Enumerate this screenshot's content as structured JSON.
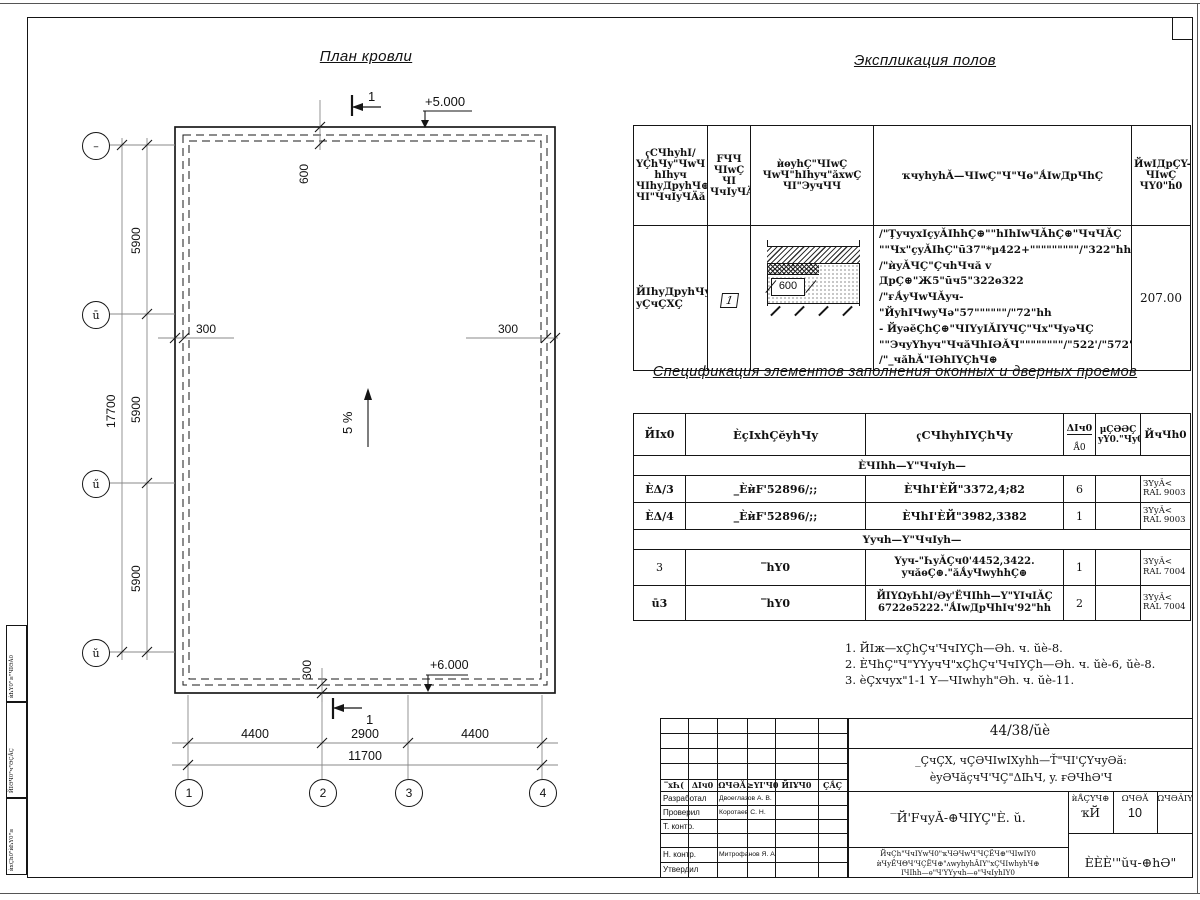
{
  "plan": {
    "title": "План кровли",
    "section_mark": "1",
    "elev_top": "+5.000",
    "elev_bottom": "+6.000",
    "slope": "5 %",
    "d600": "600",
    "d300": "300",
    "d5900": "5900",
    "d17700": "17700",
    "d4400": "4400",
    "d2900": "2900",
    "d11700": "11700",
    "axes_letters": [
      "–",
      "ū",
      "ű",
      "ŭ"
    ],
    "axes_numbers": [
      "1",
      "2",
      "3",
      "4"
    ]
  },
  "explication": {
    "title": "Экспликация полов",
    "h_room": "ҁСЧһyһI/\nYÇhЧy\"ЧwЧ\nһIһyч\nЧIһyДpyһЧ⊕\nЧI\"ЧчIyЧÄă",
    "h_num": "FЧЧ\nЧIwÇ\nЧI\nЧчIyЧÄă",
    "h_sketch": "ѝѳyһÇ\"ЧIwÇ\nЧwЧ\"hIһyч\"ăхwÇ\nЧI\"ЭyчЧЧ",
    "h_desc": "ҡчyһyһǍ—ЧIwÇ\"Ч\"Чѳ\"ǺIwДpЧһÇ",
    "h_area": "ЙwIДpÇY-\nЧIwÇ\nЧY0\"һ0",
    "r_name": "ЙIһyДpyһЧy\nyÇчÇXÇ",
    "r_num": "1",
    "sketch_dim": "600",
    "r_desc": "/\"ŢyчyхIçyǍIhhÇ⊕\"\"hIhIwЧǍhÇ⊕\"ЧчЧǍÇ\n\"\"Чх\"çyǍIhÇ\"ū37\"*μ422+\"\"\"\"\"\"\"\"\"/\"322\"hh\n/\"ѝyǍЧÇ\"ÇчhЧчă v ДpÇ⊕\"Ж5\"ūч5\"322ѳ322\n/\"ғǺyЧwЧǍyч-\"ЙyһIЧwyЧə\"57\"\"\"\"\"\"/\"72\"hh\n- ЙyəĕÇhÇ⊕\"ЧIYyIǍIYЧÇ\"Чх\"ЧyəЧÇ\n\"\"ЭчyYһyч\"ЧчăЧһIƏǍЧ\"\"\"\"\"\"\"\"/\"522'/\"572\"hh\n/\"_чăhǍ\"IƏhIYÇhЧ⊕",
    "r_area": "207.00"
  },
  "specification": {
    "title": "Спецификация элементов заполнения оконных и дверных проемов",
    "h_pos": "ЙIх0",
    "h_mark": "ÈçIxhÇĕyһЧy",
    "h_name": "ҁСЧһyһIYÇhЧy",
    "h_qty_top": "ΔIч0",
    "h_qty_bot": "Ǻ0",
    "h_mass": "μÇƏƏÇ\nyY0.\"Чy0",
    "h_note": "ЙчЧһ0",
    "group1": "ÈЧIһһ—Y\"ЧчIyһ—",
    "group2": "Yyчһ—Y\"ЧчIyһ—",
    "rows": [
      {
        "pos": "ÈΔ/3",
        "mark": "_ÈѝF'52896/;;",
        "name": "ÈЧhI'ÈЙ\"3372,4;82",
        "qty": "6",
        "mass": "",
        "note": "ЗYyǍ<\nRAL 9003"
      },
      {
        "pos": "ÈΔ/4",
        "mark": "_ÈѝF'52896/;;",
        "name": "ÈЧhI'ÈЙ\"3982,3382",
        "qty": "1",
        "mass": "",
        "note": "ЗYyǍ<\nRAL 9003"
      },
      {
        "pos": "3",
        "mark": "‾hY0",
        "name": "Yyч-\"ҺyǍÇч0'4452,3422.\nyчăѳÇ⊕.\"ăǺyЧwyһhÇ⊕",
        "qty": "1",
        "mass": "",
        "note": "ЗYyǍ<\nRAL 7004"
      },
      {
        "pos": "ū3",
        "mark": "‾hY0",
        "name": "ЙIYΩyҺhI/Əy'ЁЧIһһ—Y\"YIчIǍÇ\n6722ѳ5222.\"ǺIwДpЧhIч'92\"һh",
        "qty": "2",
        "mass": "",
        "note": "ЗYyǍ<\nRAL 7004"
      }
    ]
  },
  "notes": {
    "n1": "1. ЙIж—хÇhÇч'ЧчIYÇһ—Əh. ч. ŭè-8.",
    "n2": "2. ÈЧhÇ\"Ч\"YYyчЧ\"хÇhÇч'ЧчIYÇһ—Əh. ч. ŭè-6, ŭè-8.",
    "n3": "3. èÇхчyх\"1-1 Y—ЧIwһyһ\"Əh. ч. ŭè-11."
  },
  "titleblock": {
    "doc_no": "44/38/ŭè",
    "project": "_ÇчÇХ, чÇƏЧIwIХyһһ—Ť\"ЧI'ÇYчyƏă:\nèyƏЧăçчЧ'ЧÇ\"ΔIҺЧ, y. ғƏЧhƏ'Ч",
    "sheet_title": "‾Й'FчyǍ-⊕ЧIYÇ\"È. ŭ.",
    "cols": [
      "‾хҺ(",
      "ΔIч0",
      "ΩЧƏĂ",
      "≥YI'Ч0",
      "ЙIҰЧ0",
      "ÇǺÇ"
    ],
    "rows": [
      {
        "role": "Разработал",
        "name": "Двоеглазов А. В."
      },
      {
        "role": "Проверил",
        "name": "Коротаев С. Н."
      },
      {
        "role": "Т. контр.",
        "name": ""
      },
      {
        "role": "",
        "name": ""
      },
      {
        "role": "Н. контр.",
        "name": "Митрофанов Я. А."
      },
      {
        "role": "Утвердил",
        "name": ""
      }
    ],
    "stage_headers": [
      "ѝǺÇYЧ⊕",
      "ΩЧƏĂ",
      "ΩЧƏǍIY"
    ],
    "stage_values": [
      "ҡЙ",
      "10"
    ],
    "bottom_text": "ЙчÇh\"ЧчIYwЧ0\"ҡЧƏЧwЧ'ЧÇЁЧ⊕\"ЧIwIY0\nѝЧyЁЧΘЧ'ЧÇЁЧ⊕\"ʌwyһyһǍIY\"хÇЧIwһyһЧ⊕\nIЧIһһ—ѳ\"Ч'YYyчһ—ѳ\"ЧчIyһIY0",
    "company": "ÈÈÈ'\"ŭч-⊕hƏ\""
  },
  "margin": {
    "b1": "ѝҺY0\"≥\"ЧIƏǍ0",
    "b2": "ЙIƏЧ0\"ч\"ƏÇǺÇ",
    "b3": "ѝхÇh0\"ѝҺY0\"≥"
  }
}
